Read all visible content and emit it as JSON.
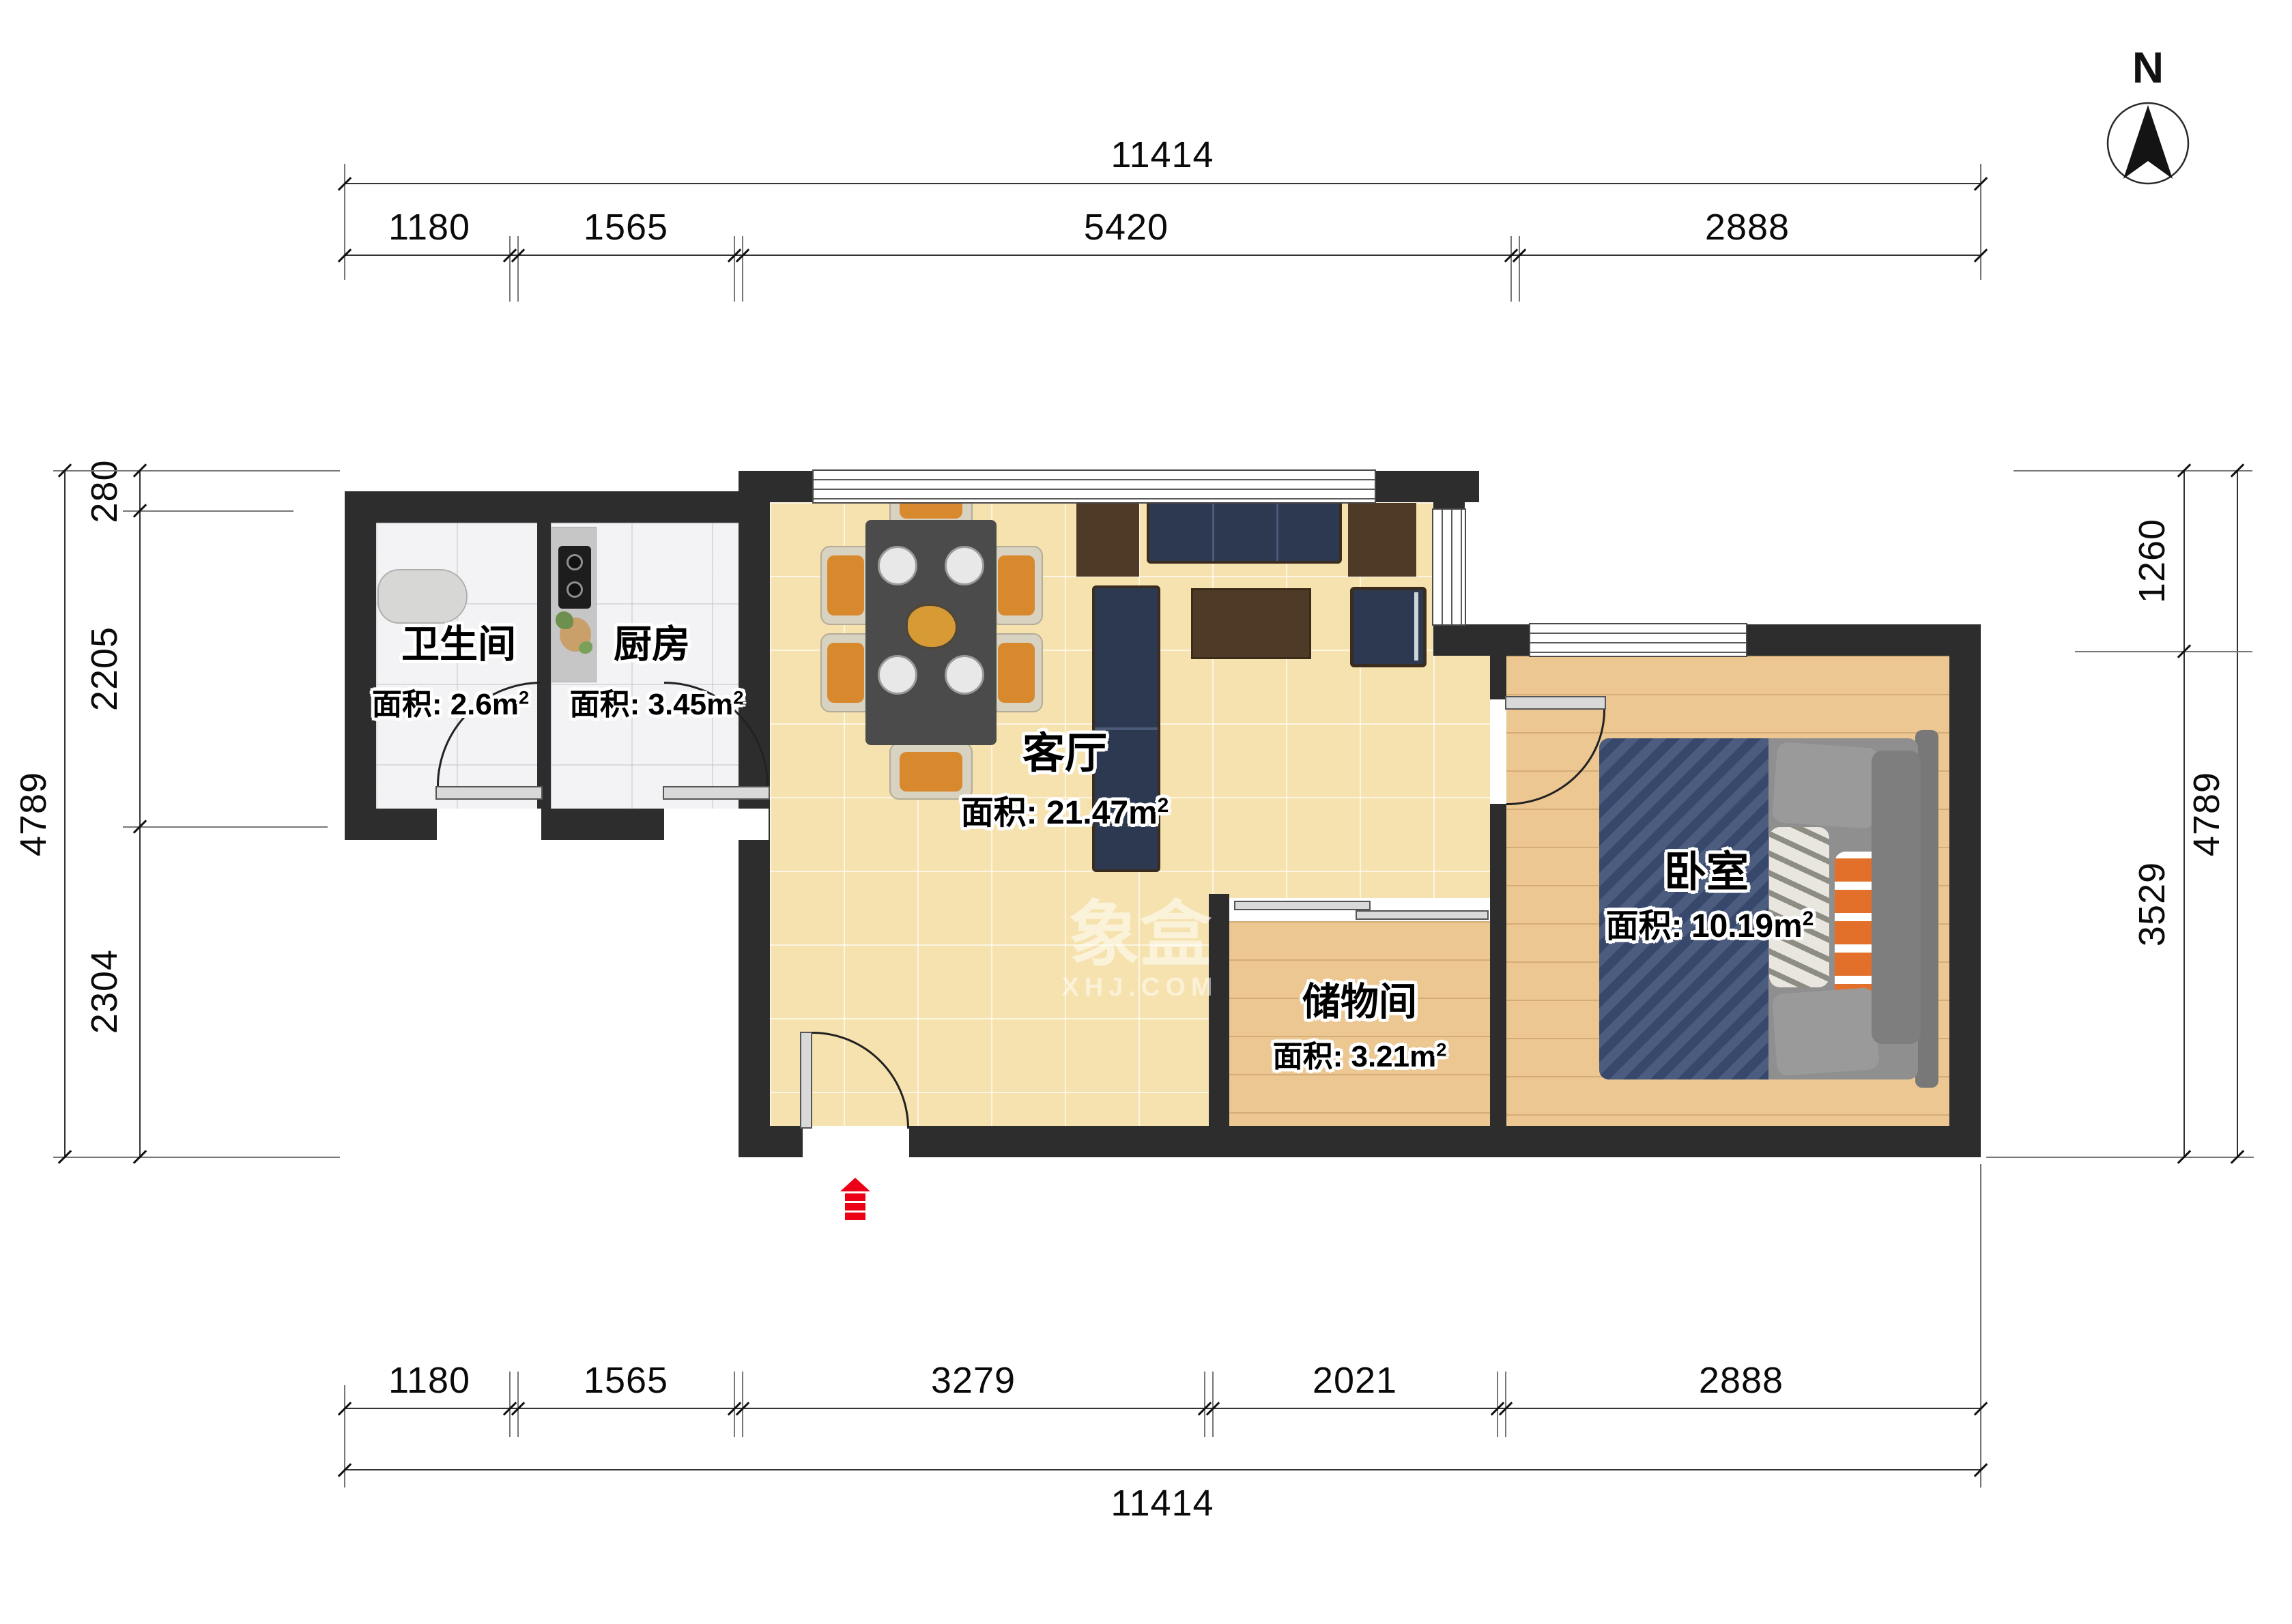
{
  "compass": {
    "label": "N"
  },
  "watermark": {
    "title": "象盒",
    "subtitle": "XHJ.COM"
  },
  "rooms": [
    {
      "id": "bathroom",
      "name": "卫生间",
      "area": "面积: 2.6m",
      "sup": "2"
    },
    {
      "id": "kitchen",
      "name": "厨房",
      "area": "面积: 3.45m",
      "sup": "2"
    },
    {
      "id": "living",
      "name": "客厅",
      "area": "面积: 21.47m",
      "sup": "2"
    },
    {
      "id": "storage",
      "name": "储物间",
      "area": "面积: 3.21m",
      "sup": "2"
    },
    {
      "id": "bedroom",
      "name": "卧室",
      "area": "面积: 10.19m",
      "sup": "2"
    }
  ],
  "dims": {
    "top_total": "11414",
    "top_segments": [
      "1180",
      "1565",
      "5420",
      "2888"
    ],
    "bottom_segments": [
      "1180",
      "1565",
      "3279",
      "2021",
      "2888"
    ],
    "bottom_total": "11414",
    "left_total": "4789",
    "left_segments": [
      "280",
      "2205",
      "2304"
    ],
    "right_segments": [
      "1260",
      "3529"
    ],
    "right_total": "4789"
  }
}
